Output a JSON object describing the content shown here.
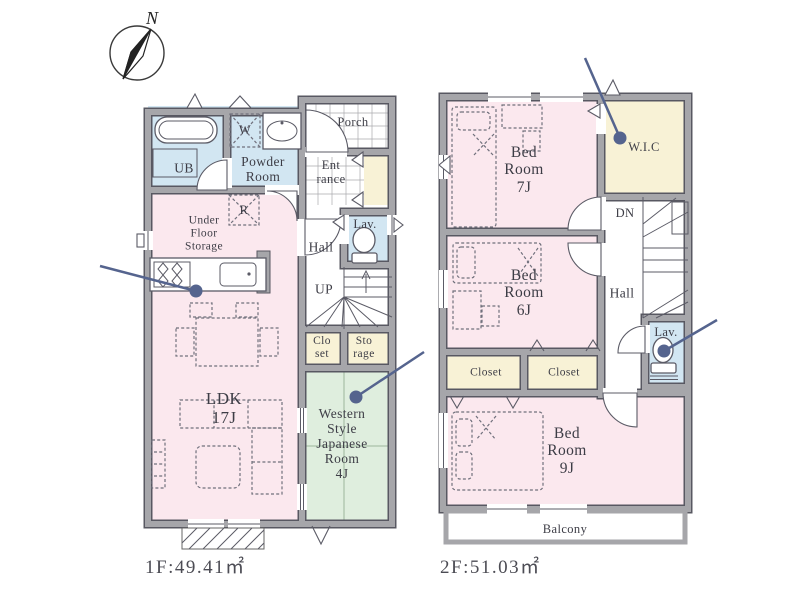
{
  "compass": {
    "north_label": "N"
  },
  "floor1": {
    "caption": "1F:49.41㎡",
    "rooms": {
      "ub": "UB",
      "powder": "Powder\nRoom",
      "washer": "W",
      "fridge": "R",
      "porch": "Porch",
      "entrance": "Ent\nrance",
      "under_floor_storage": "Under\nFloor\nStorage",
      "hall": "Hall",
      "lav": "Lav.",
      "up": "UP",
      "closet": "Clo\nset",
      "storage": "Sto\nrage",
      "ldk": "LDK\n17J",
      "japanese_room": "Western\nStyle\nJapanese\nRoom\n4J"
    }
  },
  "floor2": {
    "caption": "2F:51.03㎡",
    "rooms": {
      "bed7": "Bed\nRoom\n7J",
      "wic": "W.I.C",
      "dn": "DN",
      "hall": "Hall",
      "bed6": "Bed\nRoom\n6J",
      "closet_left": "Closet",
      "closet_right": "Closet",
      "lav": "Lav.",
      "bed9": "Bed\nRoom\n9J",
      "balcony": "Balcony"
    }
  },
  "colors": {
    "wall_gray": "#a6a6aa",
    "wall_edge": "#585862",
    "wet_area_blue": "#d2e6f2",
    "room_pink": "#fbe8ee",
    "storage_yellow": "#f8f2d6",
    "tatami_green": "#dfeede",
    "leader_blue": "#55648e",
    "text": "#3d3d46"
  }
}
